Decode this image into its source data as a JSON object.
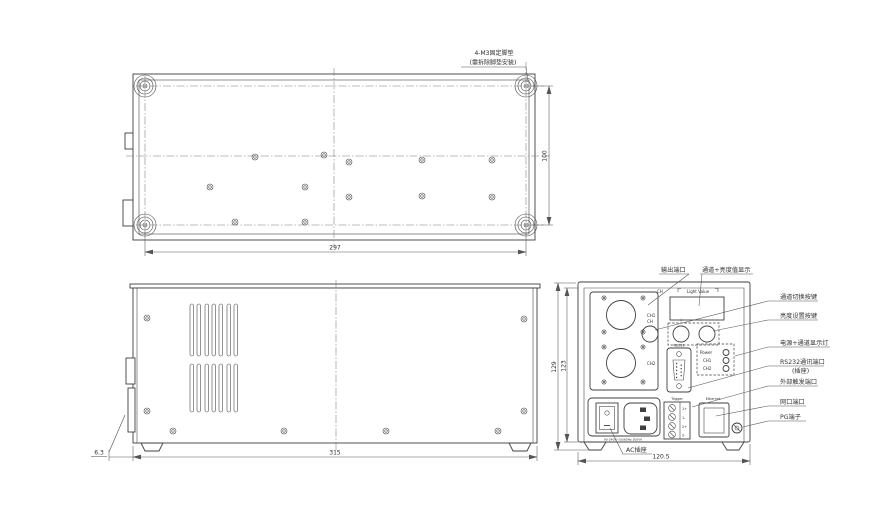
{
  "views": {
    "bottom_view": {
      "note_line1": "4-M3固定脚垫",
      "note_line2": "(需拆除脚垫安装)",
      "dim_width": "297",
      "dim_depth": "100"
    },
    "side_view": {
      "dim_width": "315",
      "dim_foot_offset": "6.3"
    },
    "rear_view": {
      "dim_height_outer": "129",
      "dim_height_inner": "123",
      "dim_width": "120.5",
      "display": {
        "ch_header": "CH",
        "value_header": "Light Value"
      },
      "buttons": {
        "ch": "CH",
        "plus": "+",
        "minus": "-"
      },
      "output": {
        "ch1": "CH1",
        "ch2": "CH2"
      },
      "rs232_label": "RS232",
      "leds": {
        "power": "Power",
        "ch1": "CH1",
        "ch2": "CH2"
      },
      "trigger_label": "Trigger",
      "trigger_pins": [
        "1+",
        "1-",
        "2+",
        "2-"
      ],
      "ethernet_label": "Ethernet",
      "ac_rating": "90-240V~50/60Hz 300VA",
      "callouts": {
        "output_port": "输出端口",
        "display": "通道+亮度值显示",
        "channel_switch": "通道切换按键",
        "brightness_set": "亮度设置按键",
        "indicator_leds": "电源+通道显示灯",
        "rs232_port": "RS232通讯端口",
        "rs232_port_sub": "(插座)",
        "trigger_port": "外部触发端口",
        "lan_port": "网口端口",
        "pg_terminal": "PG端子",
        "ac_socket": "AC插座"
      }
    }
  }
}
